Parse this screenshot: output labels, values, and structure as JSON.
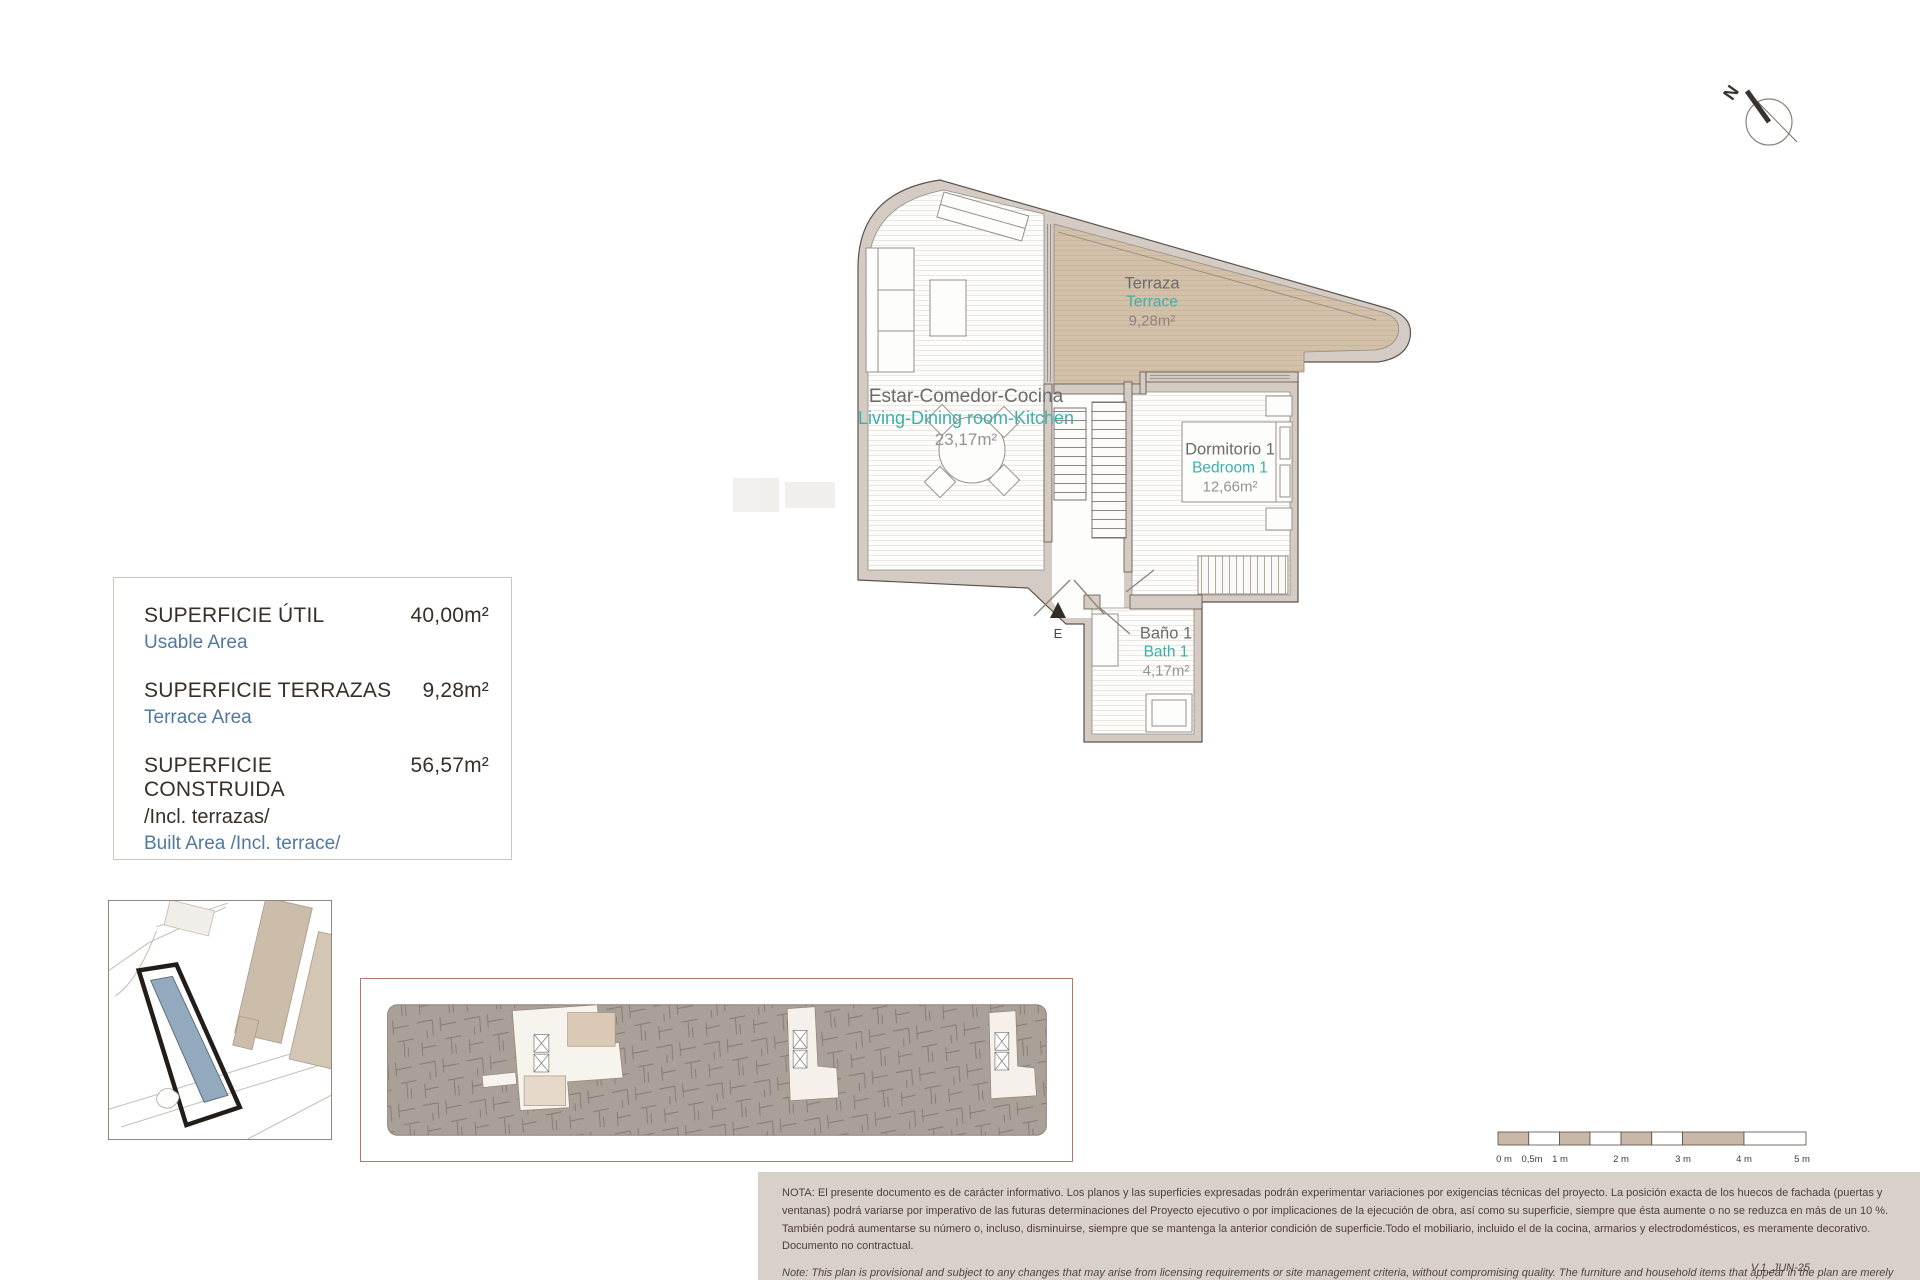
{
  "compass": {
    "north_label": "N"
  },
  "floor_plan": {
    "entry_label": "E",
    "rooms": [
      {
        "name_es": "Estar-Comedor-Cocina",
        "name_en": "Living-Dining room-Kitchen",
        "area": "23,17m²"
      },
      {
        "name_es": "Terraza",
        "name_en": "Terrace",
        "area": "9,28m²"
      },
      {
        "name_es": "Dormitorio 1",
        "name_en": "Bedroom 1",
        "area": "12,66m²"
      },
      {
        "name_es": "Baño 1",
        "name_en": "Bath 1",
        "area": "4,17m²"
      }
    ]
  },
  "area_table": {
    "rows": [
      {
        "label_es": "SUPERFICIE ÚTIL",
        "label_en": "Usable Area",
        "value": "40,00m²"
      },
      {
        "label_es": "SUPERFICIE TERRAZAS",
        "label_en": "Terrace Area",
        "value": "9,28m²"
      },
      {
        "label_es": "SUPERFICIE CONSTRUIDA",
        "label_es_2": "/Incl. terrazas/",
        "label_en": "Built Area /Incl. terrace/",
        "value": "56,57m²"
      }
    ]
  },
  "scale_bar": {
    "labels": [
      "0 m",
      "0,5m",
      "1 m",
      "2 m",
      "3 m",
      "4 m",
      "5 m"
    ]
  },
  "notes": {
    "es": "NOTA: El presente documento es de carácter informativo. Los planos y las superficies expresadas podrán experimentar variaciones por exigencias técnicas del proyecto. La posición exacta de los huecos de fachada (puertas y ventanas) podrá variarse por imperativo de las futuras determinaciones del Proyecto ejecutivo o por implicaciones de la ejecución de obra, así como su superficie, siempre que ésta aumente o no se reduzca en más de un 10 %. También podrá aumentarse su número o, incluso, disminuirse, siempre que se mantenga la anterior condición de superficie.Todo el mobiliario, incluido el de la cocina, armarios y electrodomésticos, es meramente decorativo. Documento no contractual.",
    "en": "Note: This plan is provisional and subject to any changes that may arise from licensing requirements or site management criteria, without compromising quality. The furniture and household items that appear in the plan are merely for decorative purposes. This is a non-contractual document. The imperative determinations of the Executive Project or by implications works of the execution, can change the exact position of the facade of doors and windows, as well the surface area may also be increased or even decrease not more than a 10%.",
    "version": "V.1_JUN-25"
  },
  "colors": {
    "terrace_fill": "#d2c0a9",
    "wall_fill": "#d4ccc4",
    "accent_teal": "#3cb0a8",
    "accent_blue": "#50799f",
    "site_highlight": "#93aabe",
    "note_band_bg": "#d7d1ca"
  }
}
